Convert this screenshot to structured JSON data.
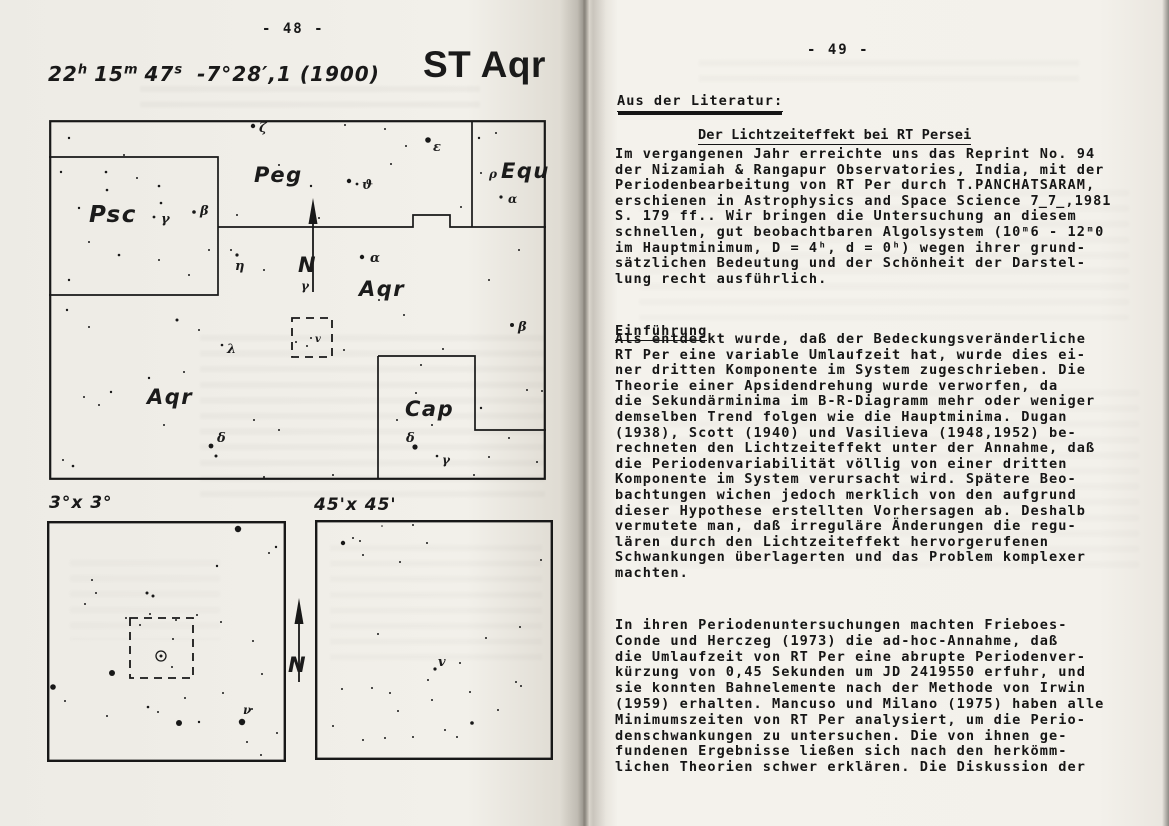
{
  "colors": {
    "ink": "#181818",
    "paper": "#f2f0ea"
  },
  "left": {
    "page_number": "- 48 -",
    "star_name": "ST Aqr",
    "ra": {
      "h_val": "22",
      "h_unit": "h",
      "m_val": "15",
      "m_unit": "m",
      "s_val": "47",
      "s_unit": "s"
    },
    "dec": "-7°28′,1 (1900)",
    "chart_labels": {
      "deg3": "3°x 3°",
      "min45": "45'x 45'"
    },
    "charts": {
      "main": {
        "frame_w": 2.2,
        "lines": [
          "M169 107 H364 V95 H401 V107 H497",
          "M423 1 V107",
          "M0 37 H169 V175 H0",
          "M329 236 H426 V310 H497",
          "M329 236 V359"
        ],
        "dashed": [
          [
            243,
            198,
            40,
            39
          ]
        ],
        "north": {
          "x": 264,
          "y1": 78,
          "y2": 172,
          "nx": 249,
          "ny": 152,
          "label": "N"
        },
        "stars": [
          [
            20,
            18,
            1.2
          ],
          [
            57,
            52,
            1.3
          ],
          [
            75,
            35,
            1
          ],
          [
            110,
            66,
            1.3
          ],
          [
            204,
            6,
            2.2
          ],
          [
            230,
            45,
            1
          ],
          [
            262,
            66,
            1.2
          ],
          [
            270,
            98,
            1
          ],
          [
            188,
            95,
            1
          ],
          [
            379,
            20,
            2.8
          ],
          [
            300,
            61,
            2.2
          ],
          [
            308,
            64,
            1.4
          ],
          [
            342,
            44,
            1
          ],
          [
            357,
            26,
            1
          ],
          [
            296,
            5,
            1
          ],
          [
            336,
            9,
            1
          ],
          [
            430,
            18,
            1.2
          ],
          [
            447,
            13,
            1
          ],
          [
            432,
            53,
            1
          ],
          [
            452,
            77,
            1.6
          ],
          [
            412,
            87,
            1
          ],
          [
            12,
            52,
            1.2
          ],
          [
            30,
            88,
            1.2
          ],
          [
            58,
            70,
            1.3
          ],
          [
            88,
            58,
            1
          ],
          [
            112,
            83,
            1.3
          ],
          [
            105,
            97,
            1.4
          ],
          [
            145,
            92,
            1.8
          ],
          [
            40,
            122,
            1
          ],
          [
            70,
            135,
            1.3
          ],
          [
            110,
            140,
            1
          ],
          [
            20,
            160,
            1.2
          ],
          [
            140,
            155,
            1
          ],
          [
            160,
            130,
            1
          ],
          [
            182,
            130,
            1
          ],
          [
            188,
            135,
            1.6
          ],
          [
            215,
            150,
            1
          ],
          [
            313,
            137,
            2.2
          ],
          [
            318,
            162,
            1
          ],
          [
            330,
            180,
            1
          ],
          [
            355,
            195,
            1
          ],
          [
            295,
            230,
            1
          ],
          [
            247,
            222,
            1
          ],
          [
            258,
            226,
            1
          ],
          [
            262,
            218,
            1
          ],
          [
            173,
            225,
            1.3
          ],
          [
            150,
            210,
            1
          ],
          [
            128,
            200,
            1.5
          ],
          [
            135,
            252,
            1
          ],
          [
            100,
            258,
            1.2
          ],
          [
            62,
            272,
            1.2
          ],
          [
            50,
            285,
            1
          ],
          [
            35,
            277,
            1
          ],
          [
            18,
            190,
            1.2
          ],
          [
            40,
            207,
            1
          ],
          [
            162,
            326,
            2.4
          ],
          [
            167,
            336,
            1.5
          ],
          [
            115,
            305,
            1
          ],
          [
            205,
            300,
            1
          ],
          [
            230,
            310,
            1
          ],
          [
            14,
            340,
            1
          ],
          [
            24,
            346,
            1.3
          ],
          [
            463,
            205,
            2
          ],
          [
            440,
            160,
            1
          ],
          [
            470,
            130,
            1
          ],
          [
            394,
            229,
            1
          ],
          [
            372,
            245,
            1
          ],
          [
            367,
            273,
            1
          ],
          [
            348,
            300,
            1
          ],
          [
            383,
            305,
            1
          ],
          [
            432,
            288,
            1.2
          ],
          [
            478,
            270,
            1
          ],
          [
            493,
            271,
            1
          ],
          [
            460,
            318,
            1
          ],
          [
            440,
            337,
            1
          ],
          [
            488,
            342,
            1
          ],
          [
            366,
            327,
            2.6
          ],
          [
            388,
            336,
            1.3
          ],
          [
            425,
            355,
            1
          ],
          [
            284,
            355,
            1
          ],
          [
            215,
            357,
            1
          ]
        ],
        "labels": [
          {
            "t": "Peg",
            "x": 205,
            "y": 62,
            "fs": 21,
            "c": "conste",
            "n": "constellation-label-peg"
          },
          {
            "t": "Psc",
            "x": 40,
            "y": 102,
            "fs": 23,
            "c": "conste",
            "n": "constellation-label-psc"
          },
          {
            "t": "Equ",
            "x": 452,
            "y": 58,
            "fs": 21,
            "c": "conste",
            "n": "constellation-label-equ"
          },
          {
            "t": "Aqr",
            "x": 310,
            "y": 176,
            "fs": 21,
            "c": "conste",
            "n": "constellation-label-aqr"
          },
          {
            "t": "Aqr",
            "x": 98,
            "y": 284,
            "fs": 21,
            "c": "conste",
            "n": "constellation-label-aqr-2"
          },
          {
            "t": "Cap",
            "x": 356,
            "y": 296,
            "fs": 21,
            "c": "conste",
            "n": "constellation-label-cap"
          },
          {
            "t": "ζ",
            "x": 210,
            "y": 12,
            "fs": 13,
            "c": "greek",
            "n": "star-label-zeta"
          },
          {
            "t": "ε",
            "x": 384,
            "y": 31,
            "fs": 13,
            "c": "greek",
            "n": "star-label-epsilon"
          },
          {
            "t": "ϑ",
            "x": 313,
            "y": 69,
            "fs": 13,
            "c": "greek",
            "n": "star-label-theta"
          },
          {
            "t": "β",
            "x": 151,
            "y": 95,
            "fs": 13,
            "c": "greek",
            "n": "star-label-beta-psc"
          },
          {
            "t": "γ",
            "x": 112,
            "y": 103,
            "fs": 13,
            "c": "greek",
            "n": "star-label-gamma-psc"
          },
          {
            "t": "η",
            "x": 186,
            "y": 150,
            "fs": 13,
            "c": "greek",
            "n": "star-label-eta"
          },
          {
            "t": "γ",
            "x": 252,
            "y": 170,
            "fs": 12,
            "c": "greek",
            "n": "star-label-gamma-aqr"
          },
          {
            "t": "α",
            "x": 321,
            "y": 142,
            "fs": 13,
            "c": "greek",
            "n": "star-label-alpha-aqr"
          },
          {
            "t": "ρ",
            "x": 440,
            "y": 58,
            "fs": 12,
            "c": "greek",
            "n": "star-label-rho-equ"
          },
          {
            "t": "α",
            "x": 459,
            "y": 83,
            "fs": 12,
            "c": "greek",
            "n": "star-label-alpha-equ"
          },
          {
            "t": "β",
            "x": 469,
            "y": 211,
            "fs": 13,
            "c": "greek",
            "n": "star-label-beta-aqr"
          },
          {
            "t": "λ",
            "x": 178,
            "y": 233,
            "fs": 13,
            "c": "greek",
            "n": "star-label-lambda"
          },
          {
            "t": "δ",
            "x": 168,
            "y": 322,
            "fs": 13,
            "c": "greek",
            "n": "star-label-delta-aqr"
          },
          {
            "t": "δ",
            "x": 357,
            "y": 322,
            "fs": 13,
            "c": "greek",
            "n": "star-label-delta-cap"
          },
          {
            "t": "γ",
            "x": 393,
            "y": 344,
            "fs": 12,
            "c": "greek",
            "n": "star-label-gamma-cap"
          },
          {
            "t": "v",
            "x": 266,
            "y": 222,
            "fs": 10,
            "c": "greek",
            "n": "variable-star-marker"
          }
        ]
      },
      "deg3": {
        "frame_w": 2.4,
        "dashed": [
          [
            83,
            97,
            63,
            60
          ]
        ],
        "target": [
          114,
          135
        ],
        "stars": [
          [
            191,
            8,
            3.2
          ],
          [
            229,
            26,
            1.2
          ],
          [
            222,
            32,
            1
          ],
          [
            170,
            45,
            1.2
          ],
          [
            45,
            59,
            1
          ],
          [
            49,
            72,
            1
          ],
          [
            100,
            72,
            1.5
          ],
          [
            106,
            75,
            1.5
          ],
          [
            38,
            83,
            1
          ],
          [
            79,
            97,
            1
          ],
          [
            103,
            93,
            1
          ],
          [
            129,
            99,
            1
          ],
          [
            174,
            101,
            1
          ],
          [
            93,
            104,
            1
          ],
          [
            150,
            94,
            1
          ],
          [
            126,
            118,
            1
          ],
          [
            125,
            146,
            1
          ],
          [
            65,
            152,
            3
          ],
          [
            6,
            166,
            2.8
          ],
          [
            18,
            180,
            1
          ],
          [
            101,
            186,
            1.3
          ],
          [
            111,
            191,
            1
          ],
          [
            138,
            177,
            1
          ],
          [
            132,
            202,
            3
          ],
          [
            152,
            201,
            1.2
          ],
          [
            195,
            201,
            3.2
          ],
          [
            176,
            172,
            1
          ],
          [
            215,
            153,
            1
          ],
          [
            206,
            120,
            1
          ],
          [
            200,
            221,
            1
          ],
          [
            214,
            234,
            1
          ],
          [
            230,
            212,
            1
          ],
          [
            60,
            195,
            1
          ],
          [
            205,
            188,
            1
          ]
        ],
        "labels": [
          {
            "t": "ν",
            "x": 196,
            "y": 193,
            "fs": 12,
            "c": "greek",
            "n": "star-label-nu"
          }
        ]
      },
      "min45": {
        "frame_w": 2.4,
        "stars": [
          [
            28,
            23,
            2.2
          ],
          [
            38,
            18,
            1
          ],
          [
            45,
            21,
            1
          ],
          [
            48,
            35,
            1
          ],
          [
            85,
            42,
            1
          ],
          [
            112,
            23,
            1
          ],
          [
            67,
            6,
            0.8
          ],
          [
            98,
            5,
            1
          ],
          [
            226,
            40,
            1
          ],
          [
            205,
            107,
            1
          ],
          [
            63,
            114,
            1
          ],
          [
            171,
            118,
            1
          ],
          [
            120,
            149,
            1.6
          ],
          [
            145,
            143,
            1
          ],
          [
            113,
            160,
            1
          ],
          [
            201,
            162,
            1
          ],
          [
            206,
            166,
            1
          ],
          [
            27,
            169,
            1
          ],
          [
            57,
            168,
            1
          ],
          [
            75,
            173,
            1
          ],
          [
            155,
            172,
            1
          ],
          [
            117,
            180,
            1
          ],
          [
            83,
            191,
            1
          ],
          [
            183,
            190,
            1
          ],
          [
            18,
            206,
            1
          ],
          [
            48,
            220,
            1
          ],
          [
            70,
            218,
            1
          ],
          [
            98,
            217,
            1
          ],
          [
            130,
            210,
            1
          ],
          [
            157,
            203,
            1.8
          ],
          [
            142,
            217,
            1
          ]
        ],
        "labels": [
          {
            "t": "v",
            "x": 123,
            "y": 146,
            "fs": 13,
            "c": "greek",
            "n": "variable-star-marker"
          }
        ]
      },
      "mid": {
        "frame": false,
        "north": {
          "x": 14,
          "y1": 6,
          "y2": 90,
          "nx": 3,
          "ny": 80,
          "label": "N"
        }
      }
    }
  },
  "right": {
    "page_number": "- 49 -",
    "section_header": "Aus der Literatur:",
    "title": "Der Lichtzeiteffekt bei RT Persei",
    "subheading": "Einführung",
    "para1": "Im vergangenen Jahr erreichte uns das Reprint No. 94\nder Nizamiah & Rangapur Observatories, India, mit der\nPeriodenbearbeitung von RT Per durch T.PANCHATSARAM,\nerschienen in Astrophysics and Space Science 7̲7̲,1981\nS. 179 ff.. Wir bringen die Untersuchung an diesem\nschnellen, gut beobachtbaren Algolsystem (10ᵐ6 - 12ᵐ0\nim Hauptminimum, D = 4ʰ, d = 0ʰ) wegen ihrer grund-\nsätzlichen Bedeutung und der Schönheit der Darstel-\nlung recht ausführlich.",
    "para2": "Als entdeckt wurde, daß der Bedeckungsveränderliche\nRT Per eine variable Umlaufzeit hat, wurde dies ei-\nner dritten Komponente im System zugeschrieben. Die\nTheorie einer Apsidendrehung wurde verworfen, da\ndie Sekundärminima im B-R-Diagramm mehr oder weniger\ndemselben Trend folgen wie die Hauptminima. Dugan\n(1938), Scott (1940) und Vasilieva (1948,1952) be-\nrechneten den Lichtzeiteffekt unter der Annahme, daß\ndie Periodenvariabilität völlig von einer dritten\nKomponente im System verursacht wird. Spätere Beo-\nbachtungen wichen jedoch merklich von den aufgrund\ndieser Hypothese erstellten Vorhersagen ab. Deshalb\nvermutete man, daß irreguläre Änderungen die regu-\nlären durch den Lichtzeiteffekt hervorgerufenen\nSchwankungen überlagerten und das Problem komplexer\nmachten.",
    "para3": "In ihren Periodenuntersuchungen machten Frieboes-\nConde und Herczeg (1973) die ad-hoc-Annahme, daß\ndie Umlaufzeit von RT Per eine abrupte Periodenver-\nkürzung von 0,45 Sekunden um JD 2419550 erfuhr, und\nsie konnten Bahnelemente nach der Methode von Irwin\n(1959) erhalten. Mancuso und Milano (1975) haben alle\nMinimumszeiten von RT Per analysiert, um die Perio-\ndenschwankungen zu untersuchen. Die von ihnen ge-\nfundenen Ergebnisse ließen sich nach den herkömm-\nlichen Theorien schwer erklären. Die Diskussion der"
  }
}
